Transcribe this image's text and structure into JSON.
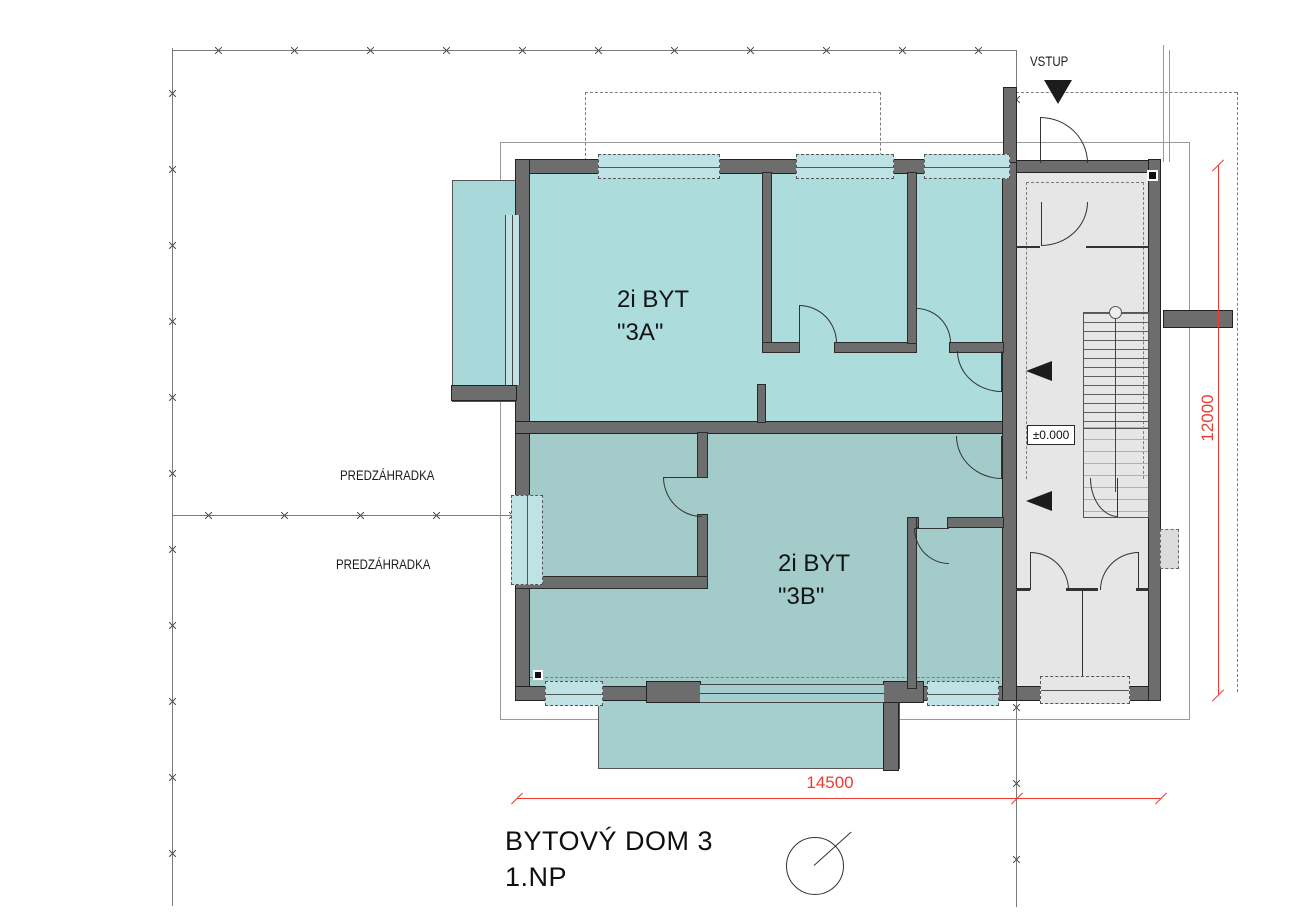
{
  "drawing": {
    "title_line1": "BYTOVÝ DOM 3",
    "title_line2": "1.NP"
  },
  "labels": {
    "entrance": "VSTUP",
    "front_garden_upper": "PREDZÁHRADKA",
    "front_garden_lower": "PREDZÁHRADKA",
    "apartment_a_line1": "2i BYT",
    "apartment_a_line2": "\"3A\"",
    "apartment_b_line1": "2i BYT",
    "apartment_b_line2": "\"3B\"",
    "level_marker": "±0.000"
  },
  "dimensions": {
    "overall_width_mm": "14500",
    "overall_height_mm": "12000"
  },
  "colors": {
    "apartment_a_fill": "#addcdd",
    "apartment_b_fill": "#a2cbca",
    "terrace_a_fill": "#a9d8da",
    "terrace_b_fill": "#a5cfce",
    "common_area_fill": "#e6e6e6",
    "wall_fill": "#6d6d6d",
    "dimension_red": "#ee3b31",
    "window_fill": "#bfe3e4"
  }
}
